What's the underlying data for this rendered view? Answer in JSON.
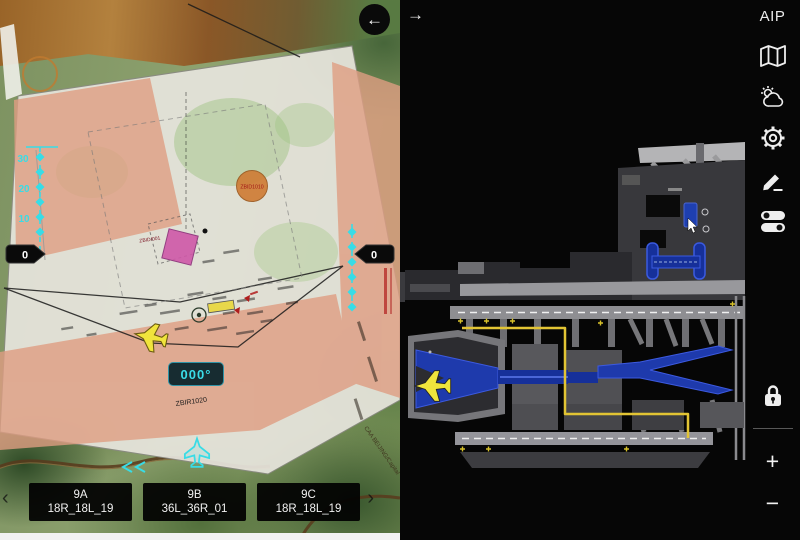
{
  "left_panel": {
    "back_icon": "←",
    "heading_readout": "000°",
    "scale": {
      "labels": [
        "30",
        "20",
        "10"
      ],
      "left_marker": "0",
      "right_marker": "0"
    },
    "waypoints": {
      "circle_label": "ZBID1010",
      "square_label": "ZBID/001",
      "bottom_label": "ZBIR1020"
    },
    "margin_text": "CAA BEIJING/Capital",
    "procedures": [
      {
        "code": "9A",
        "runways": "18R_18L_19"
      },
      {
        "code": "9B",
        "runways": "36L_36R_01"
      },
      {
        "code": "9C",
        "runways": "18R_18L_19"
      }
    ],
    "prev_chevron": "‹",
    "next_chevron": "›"
  },
  "right_panel": {
    "expand_icon": "→"
  },
  "sidebar": {
    "aip_label": "AIP",
    "zoom_in": "+",
    "zoom_out": "−",
    "icons": [
      "map-icon",
      "weather-icon",
      "settings-icon",
      "edit-icon",
      "toggles-icon",
      "lock-icon"
    ]
  },
  "colors": {
    "accent_cyan": "#38dce6",
    "route_yellow": "#e2c434",
    "apron_blue": "#1e3aac",
    "ownship_yellow": "#f0e43c",
    "restricted_salmon": "#df9d82"
  }
}
